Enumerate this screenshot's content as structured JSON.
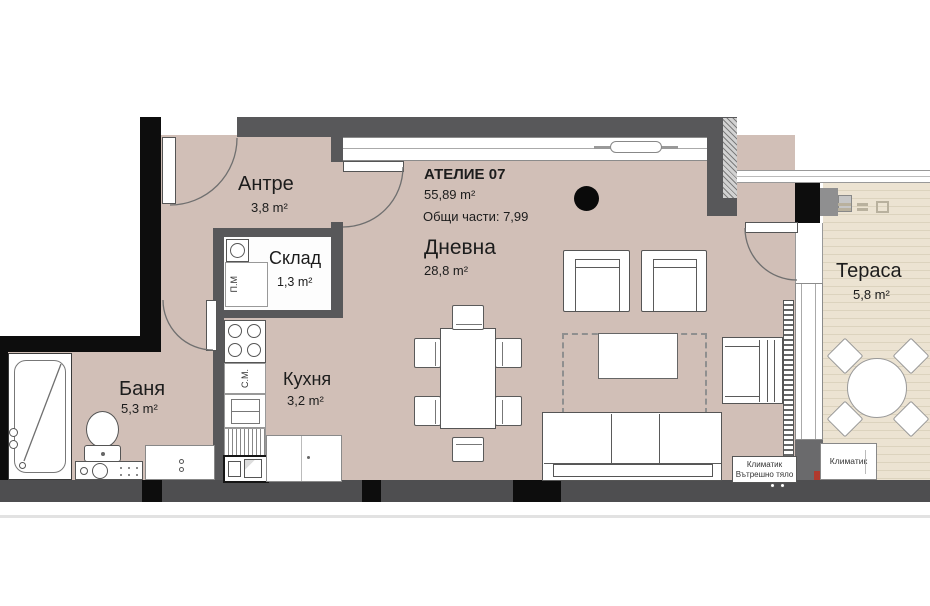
{
  "unit": {
    "title": "АТЕЛИЕ 07",
    "area": "55,89 m²",
    "common_parts": "Общи части: 7,99"
  },
  "rooms": {
    "entry": {
      "name": "Антре",
      "area": "3,8 m²"
    },
    "storage": {
      "name": "Склад",
      "area": "1,3 m²"
    },
    "bathroom": {
      "name": "Баня",
      "area": "5,3 m²"
    },
    "kitchen": {
      "name": "Кухня",
      "area": "3,2 m²"
    },
    "living": {
      "name": "Дневна",
      "area": "28,8 m²"
    },
    "terrace": {
      "name": "Тераса",
      "area": "5,8 m²"
    }
  },
  "appliances": {
    "washing_machine": "П.М",
    "dishwasher": "С.М."
  },
  "hvac": {
    "indoor_unit_line1": "Климатик",
    "indoor_unit_line2": "Вътрешно тяло",
    "terrace_unit": "Климатик"
  },
  "colors": {
    "floor": "#d1bfb7",
    "deck": "#e9e0cf",
    "wall": "#58585a",
    "wall_black": "#0d0d0d",
    "outline": "#555555"
  }
}
